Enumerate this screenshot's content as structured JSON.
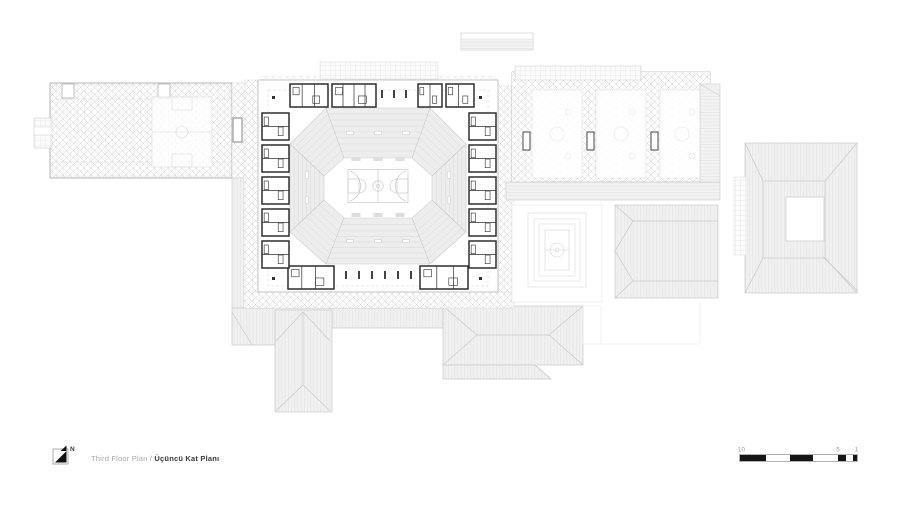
{
  "drawing": {
    "title_en": "Third Floor Plan /",
    "title_tr": "Üçüncü Kat Planı",
    "north_label": "N",
    "scale_bar": {
      "labels": [
        "10",
        "5",
        "1"
      ]
    },
    "colors": {
      "ink": "#111111",
      "wall": "#2e2e2e",
      "line": "#c8c8c8",
      "tier": "#d9d9d9",
      "radial": "#c6c6c6",
      "faint": "#e3e3e3",
      "label_gray": "#9b9b9b"
    }
  }
}
